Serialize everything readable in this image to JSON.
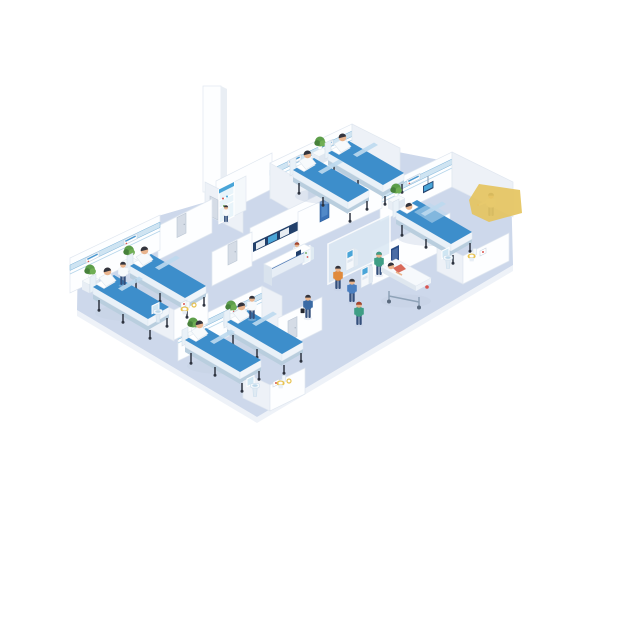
{
  "scene": {
    "description": "Isometric illustration of a hospital floor with patient rooms, reception desk, self check-in kiosks, corridor with stretcher and en-suite bathrooms",
    "areas": {
      "patient_room_top": {
        "name": "Patient room - top",
        "beds": 2,
        "patients_sitting": 2,
        "wall_panels": 2,
        "plants": 1
      },
      "patient_room_right": {
        "name": "Patient room - right",
        "beds": 1,
        "patients_lying": 1,
        "staff": [
          "doctor"
        ],
        "equipment": [
          "overbed-monitor"
        ],
        "wall_panels": 1,
        "plants": 1
      },
      "patient_room_left": {
        "name": "Patient room - left",
        "beds": 2,
        "patients_sitting": 2,
        "staff": [
          "nurse"
        ],
        "wall_panels": 2,
        "plants": 2
      },
      "patient_room_bottom": {
        "name": "Patient room - bottom",
        "beds": 2,
        "patients_sitting": 2,
        "staff": [
          "nurse"
        ],
        "wall_panels": 2,
        "plants": 2
      },
      "reception": {
        "name": "Reception",
        "staff": [
          "receptionist"
        ],
        "wall_monitor_band_screens": 3,
        "desk": "counter with dark blue signage band",
        "display_case": 1
      },
      "kiosk_area": {
        "name": "Self check-in",
        "kiosks": 2,
        "users": [
          "man-orange-shirt",
          "man-blue-shirt"
        ],
        "glass_partition": true
      },
      "corridor": {
        "name": "Corridor",
        "people": [
          "man-navy-suit-with-briefcase",
          "nurse-green-scrubs-walking",
          "nurse-pushing-stretcher"
        ],
        "stretcher_patients": 1,
        "doors_gray": 4,
        "doors_blue": 1,
        "wall_poster": 1
      },
      "supply_room": {
        "name": "Supply room",
        "glass_cabinet": 1,
        "white_cabinet": 1,
        "staff": [
          "attendant"
        ]
      },
      "bathrooms": {
        "name": "En-suite bathrooms",
        "count": 3,
        "fixtures": [
          "pedestal-sink",
          "mirror",
          "toilet-yellow-seat",
          "wall-picture",
          "towel-ring"
        ]
      }
    },
    "people_total": 18,
    "extra_shapes": {
      "yellow_polygon": "flat yellow shape overlapping right wall"
    },
    "palette": {
      "pageBg": "#ffffff",
      "floor": "#cdd8eb",
      "floorEdge": "#eef2f8",
      "wallFace": "#fdfeff",
      "wallSide": "#edf1f7",
      "wallStroke": "#e0e7f0",
      "columnSide": "#e9eef4",
      "trim": "#cfe4f2",
      "trimLine": "#79b2d8",
      "panelStroke": "#c7d4e2",
      "panelBlue": "#4f9ad1",
      "bedBlue": "#3d8ecb",
      "bedFold": "#bcd9ee",
      "bedFrame": "#e9f1f8",
      "bedUnder": "#b9cede",
      "bedFoot": "#f0f5fa",
      "legDark": "#2e3440",
      "pillow": "#ffffff",
      "skin": "#e9b48d",
      "hairDark": "#33343d",
      "hairAuburn": "#a8442c",
      "gownWhite": "#f7fafc",
      "scrubGreen": "#3f9e85",
      "orange": "#e08a3c",
      "blueShirt": "#4a7fc1",
      "suitBlue": "#3a6aa4",
      "trouser": "#35507c",
      "plantGreen": "#5d9e4a",
      "plantDark": "#47813b",
      "plantLight": "#6fae54",
      "potWhite": "#ffffff",
      "standTop": "#f7fafc",
      "standFront": "#e8eef5",
      "standSide": "#dfe7f0",
      "deskFront": "#e7eef6",
      "deskBand": "#2b5ea7",
      "deskEnd": "#d9e3ee",
      "monitorFrame": "#22406b",
      "screenBlue": "#49a5d8",
      "screenGray": "#e8edf2",
      "glass": "#dce9f4",
      "kioskBody": "#f5f8fb",
      "kioskSide": "#e2eaf2",
      "door": "#d5dce6",
      "doorStroke": "#bac5d3",
      "doorBlue": "#3a72b8",
      "doorBlueInner": "#5b93cf",
      "poster": "#2b4d86",
      "posterInner": "#4a6da6",
      "coral": "#d96a5a",
      "toiletSeat": "#e8c24f",
      "fixture": "#dfeaf3",
      "fixtureDeep": "#bcd8ea",
      "mirror": "#cfe6f3",
      "shadow": "#c3cfe2",
      "yellow": "#e5c45f",
      "red": "#d9534f",
      "stretcherSide": "#dfe7ef",
      "metal": "#8fa3b8"
    }
  }
}
